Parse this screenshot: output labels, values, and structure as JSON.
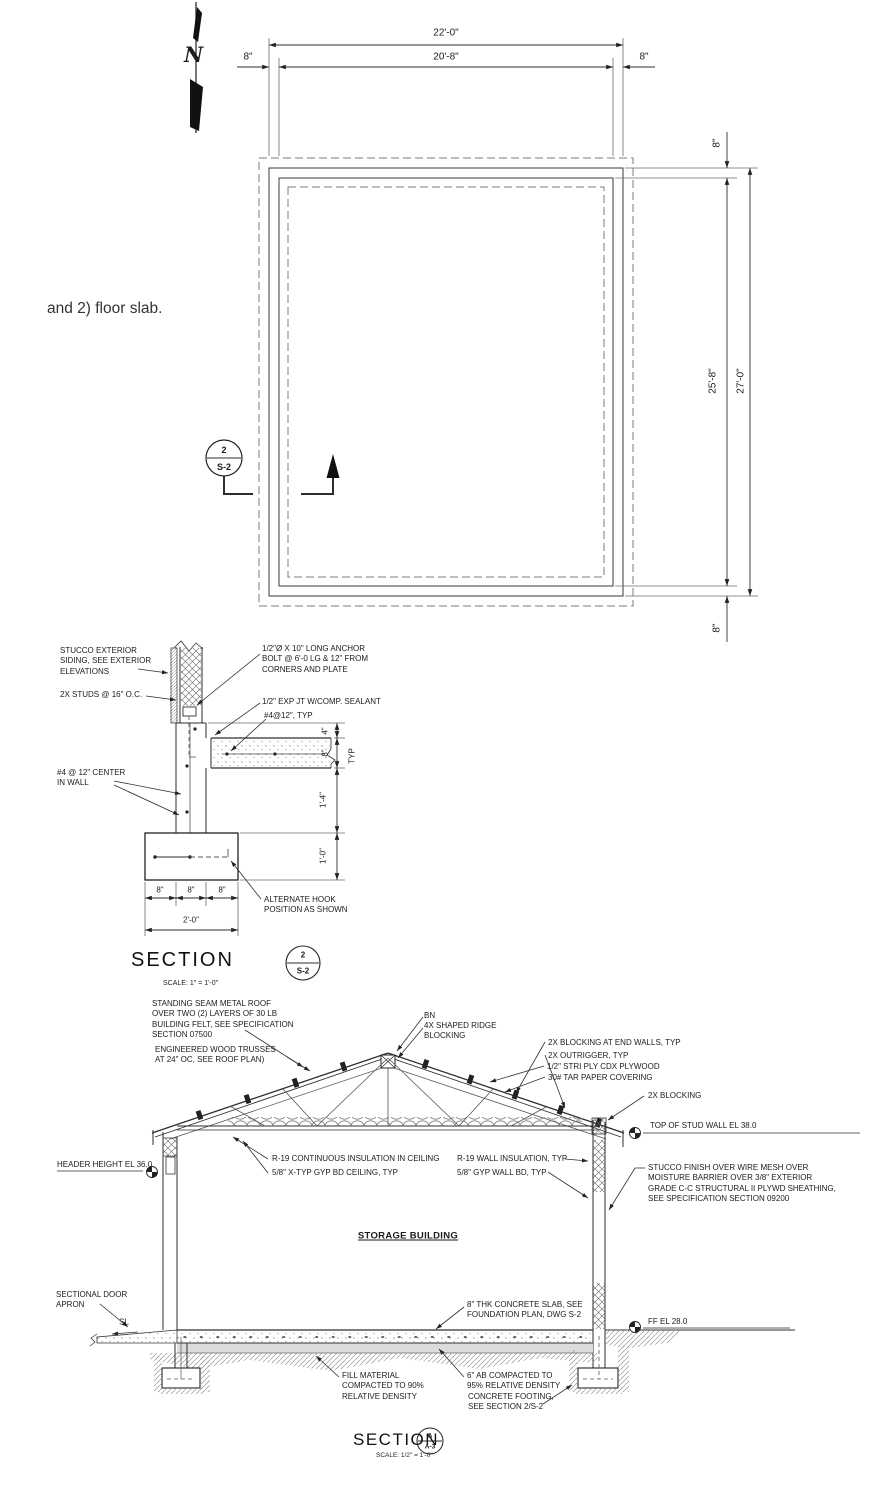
{
  "note": {
    "text": "and 2) floor slab."
  },
  "plan": {
    "north": "N",
    "dim_overall_w": "22'-0\"",
    "dim_inner_w": "20'-8\"",
    "dim_wall_left": "8\"",
    "dim_wall_right": "8\"",
    "dim_wall_top": "8\"",
    "dim_wall_bottom": "8\"",
    "dim_inner_h": "25'-8\"",
    "dim_overall_h": "27'-0\"",
    "marker": {
      "num": "2",
      "sheet": "S-2"
    }
  },
  "wall_detail": {
    "labels": {
      "stucco": "STUCCO EXTERIOR\nSIDING, SEE EXTERIOR\nELEVATIONS",
      "studs": "2X STUDS @ 16\" O.C.",
      "anchor": "1/2\"Ø X 10\" LONG ANCHOR\nBOLT @ 6'-0 LG & 12\" FROM\nCORNERS AND PLATE",
      "expjt": "1/2\" EXP JT W/COMP. SEALANT",
      "slab_bar": "#4@12\", TYP",
      "wall_bar": "#4 @ 12\" CENTER\nIN WALL",
      "alt_hook": "ALTERNATE HOOK\nPOSITION AS SHOWN"
    },
    "dims": {
      "d4": "4\"",
      "d8": "8\"",
      "typ": "TYP",
      "d14": "1'-4\"",
      "d10": "1'-0\"",
      "b8a": "8\"",
      "b8b": "8\"",
      "b8c": "8\"",
      "b20": "2'-0\""
    },
    "title": {
      "label": "SECTION",
      "num": "2",
      "sheet": "S-2",
      "scale": "SCALE: 1\" = 1'-0\""
    }
  },
  "building_section": {
    "labels": {
      "standing_seam": "STANDING SEAM METAL ROOF\nOVER TWO (2) LAYERS OF 30 LB\nBUILDING FELT, SEE SPECIFICATION\nSECTION 07500",
      "trusses": "ENGINEERED WOOD TRUSSES\nAT 24\" OC, SEE ROOF PLAN)",
      "bn": "BN",
      "ridge_blocking": "4X SHAPED RIDGE\nBLOCKING",
      "blocking_endwalls": "2X BLOCKING AT END WALLS, TYP",
      "outrigger": "2X OUTRIGGER, TYP",
      "plywood": "1/2\" STRI PLY CDX PLYWOOD",
      "tar_paper": "30# TAR PAPER COVERING",
      "blocking_2x": "2X BLOCKING",
      "top_of_stud": "TOP OF STUD WALL EL 38.0",
      "header_height": "HEADER HEIGHT EL 36.0",
      "r19_ceiling": "R-19 CONTINUOUS INSULATION IN CEILING",
      "gyp_ceiling": "5/8\" X-TYP GYP BD CEILING, TYP",
      "r19_wall": "R-19  WALL INSULATION, TYP",
      "gyp_wall": "5/8\" GYP WALL BD, TYP",
      "stucco_finish": "STUCCO FINISH OVER WIRE MESH OVER\nMOISTURE BARRIER OVER 3/8\" EXTERIOR\nGRADE C-C STRUCTURAL II PLYWD SHEATHING,\nSEE SPECIFICATION SECTION 09200",
      "room_name": "STORAGE BUILDING",
      "door_apron": "SECTIONAL DOOR\nAPRON",
      "sl": "SL",
      "slab": "8\" THK CONCRETE SLAB, SEE\nFOUNDATION PLAN, DWG S-2",
      "ff_el": "FF EL 28.0",
      "fill_material": "FILL MATERIAL\nCOMPACTED TO 90%\nRELATIVE DENSITY",
      "agg_base": "6\" AB COMPACTED TO\n95% RELATIVE DENSITY",
      "conc_footing": "CONCRETE FOOTING,\nSEE SECTION 2/S-2"
    },
    "title": {
      "label": "SECTION",
      "num": "A",
      "sheet": "A-3",
      "scale": "SCALE: 1/2\" = 1'-0\""
    }
  }
}
